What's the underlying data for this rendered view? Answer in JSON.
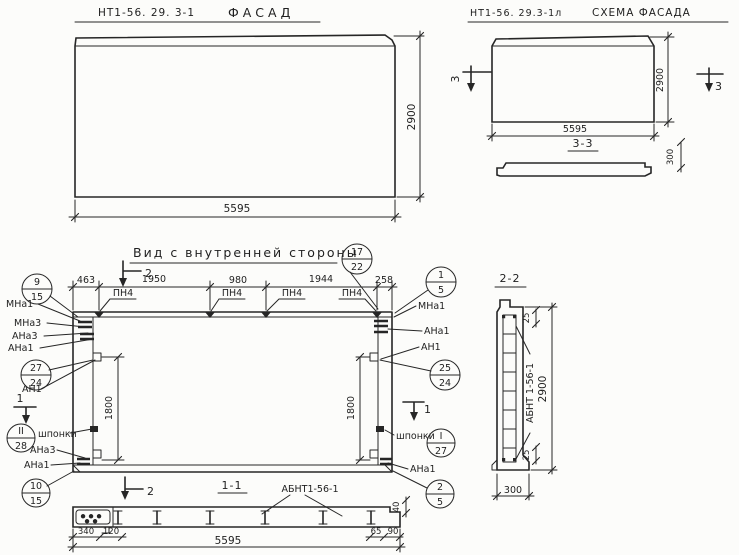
{
  "palette": {
    "ink": "#262626",
    "paper": "#fcfcfa"
  },
  "facade": {
    "code": "НТ1-56. 29. 3-1",
    "title": "ФАСАД",
    "dim_width": "5595",
    "dim_height": "2900"
  },
  "schema": {
    "code": "НТ1-56. 29.3-1л",
    "title": "СХЕМА ФАСАДА",
    "dim_width": "5595",
    "dim_height": "2900",
    "cut_label": "3",
    "section_title": "3-3",
    "dim_thickness": "300"
  },
  "inner": {
    "title": "Вид с внутренней стороны",
    "dims_top": [
      "463",
      "1950",
      "980",
      "1944",
      "258"
    ],
    "dim_left": "1800",
    "dim_right": "1800",
    "pn4": "ПН4",
    "shponki": "шпонки",
    "cut_v": "2",
    "cut_h": "1",
    "left_labels": [
      "МНа1",
      "МНа3",
      "АНа3",
      "АНа1",
      "АН1",
      "АНа3",
      "АНа1"
    ],
    "right_labels": [
      "МНа1",
      "АНа1",
      "АН1",
      "АНа1"
    ],
    "marks": {
      "m9_15": {
        "top": "9",
        "bottom": "15"
      },
      "m17_22": {
        "top": "17",
        "bottom": "22"
      },
      "m1_5": {
        "top": "1",
        "bottom": "5"
      },
      "m27_24": {
        "top": "27",
        "bottom": "24"
      },
      "m25_24": {
        "top": "25",
        "bottom": "24"
      },
      "mII_28": {
        "top": "II",
        "bottom": "28"
      },
      "mI_27": {
        "top": "I",
        "bottom": "27"
      },
      "m10_15": {
        "top": "10",
        "bottom": "15"
      },
      "m2_5": {
        "top": "2",
        "bottom": "5"
      }
    }
  },
  "section11": {
    "title": "1-1",
    "part_label": "АБНТ1-56-1",
    "dim_340": "340",
    "dim_120": "120",
    "dim_width": "5595",
    "dim_65": "65",
    "dim_90": "90",
    "dim_40": "40"
  },
  "section22": {
    "title": "2-2",
    "part_label": "АБНТ 1-56-1",
    "dim_25_top": "25",
    "dim_25_bottom": "25",
    "dim_height": "2900",
    "dim_width": "300"
  }
}
